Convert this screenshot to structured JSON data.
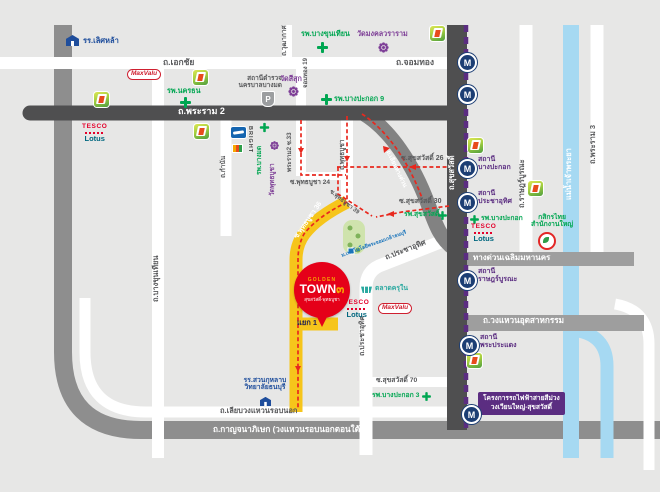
{
  "map": {
    "road_labels": {
      "ekkachai": "ถ.เอกชัย",
      "chomthong": "ถ.จอมทอง",
      "wutthakat": "ถ.วุฒากาศ",
      "chomthong19": "จอมทอง 19",
      "rama2": "ถ.พระราม 2",
      "bangkhunthian": "ถ.บางขุนเทียน",
      "kamnan": "ถ.กำนัน",
      "rama2_soi33": "พระราม2 ซ.33",
      "phutthabucha24": "ซ.พุทธบูชา 24",
      "phutthabucha": "ถ.พุทธบูชา",
      "phutthabucha36": "ซ.พุทธบูชา 36",
      "phutthabucha39": "ซ.พุทธบูชา 39",
      "suksawat": "ถ.สุขสวัสดิ์",
      "suksawat26": "ซ.สุขสวัสดิ์ 26",
      "suksawat30": "ซ.สุขสวัสดิ์ 30",
      "suksawat70": "ซ.สุขสวัสดิ์ 70",
      "prachauthit": "ถ.ประชาอุทิศ",
      "ratburana": "ถ.ราษฎร์บูรณะ",
      "rama3": "ถ.พระราม 3",
      "river": "แม่น้ำเจ้าพระยา",
      "expressway": "ทางด่วนเฉลิมมหานคร",
      "liap_expressway": "ถ.เลียบทางด่วน",
      "industrial_ring": "ถ.วงแหวนอุตสาหกรรม",
      "liap_wongwaen": "ถ.เลียบวงแหวนรอบนอก",
      "kanchanaphisek": "ถ.กาญจนาภิเษก (วงแหวนรอบนอกตอนใต้)",
      "yaek1": "แยก 1"
    },
    "places": {
      "lertlah_school": "รร.เลิศหล้า",
      "nakhonthon_hospital": "รพ.นครธน",
      "bangkhunthian_hospital": "รพ.บางขุนเทียน",
      "mongkhon_temple": "วัดมงคลวราราม",
      "bangmod_police_1": "สถานีตำรวจ",
      "bangmod_police_2": "นครบาลบางมด",
      "sisuk_temple": "วัดสีสุก",
      "bangpakok9_hospital": "รพ.บางปะกอก 9",
      "bangmod_hospital": "รพ.บางมด",
      "phutthabucha_temple": "วัดพุทธบูชา",
      "bright": "BRIGHT",
      "suksawat_hospital": "รพ.สุขสวัสดิ์",
      "kmutt": "ม.เทคโนโลยีพระจอมเกล้าธนบุรี",
      "krunai_market": "ตลาดครุใน",
      "bangpakok_hospital": "รพ.บางปะกอก",
      "bangpakok3_hospital": "รพ.บางปะกอก 3",
      "kbank_1": "กสิกรไทย",
      "kbank_2": "สำนักงานใหญ่",
      "suankularb_1": "รร.สวนกุหลาบ",
      "suankularb_2": "วิทยาลัยธนบุรี"
    },
    "stations": {
      "prefix": "สถานี",
      "bangpakok": "บางปะกอก",
      "prachauthit": "ประชาอุทิศ",
      "ratburana": "ราษฎร์บูรณะ",
      "phrapradaeng": "พระประแดง"
    },
    "purple_line_project": {
      "line1": "โครงการรถไฟฟ้าสายสีม่วง",
      "line2": "วงเวียนใหญ่-สุขสวัสดิ์"
    },
    "brands": {
      "maxvalu": "MaxValu",
      "tesco": "TESCO",
      "lotus": "Lotus"
    },
    "golden_town": {
      "top": "GOLDEN",
      "name": "TOWN",
      "number": "๓",
      "subtitle": "สุขสวัสดิ์-พุทธบูชา"
    },
    "icons": {
      "metro_letter": "M",
      "police_letter": "P"
    },
    "colors": {
      "route_red": "#e8281e",
      "mrt_purple": "#5b2d81",
      "road_dark": "#4f4f50",
      "river_blue": "#a6d9f2",
      "yellow_road": "#f6c51b",
      "golden_red": "#e50019",
      "hospital_green": "#00a651",
      "temple_purple": "#7e3f97"
    }
  }
}
